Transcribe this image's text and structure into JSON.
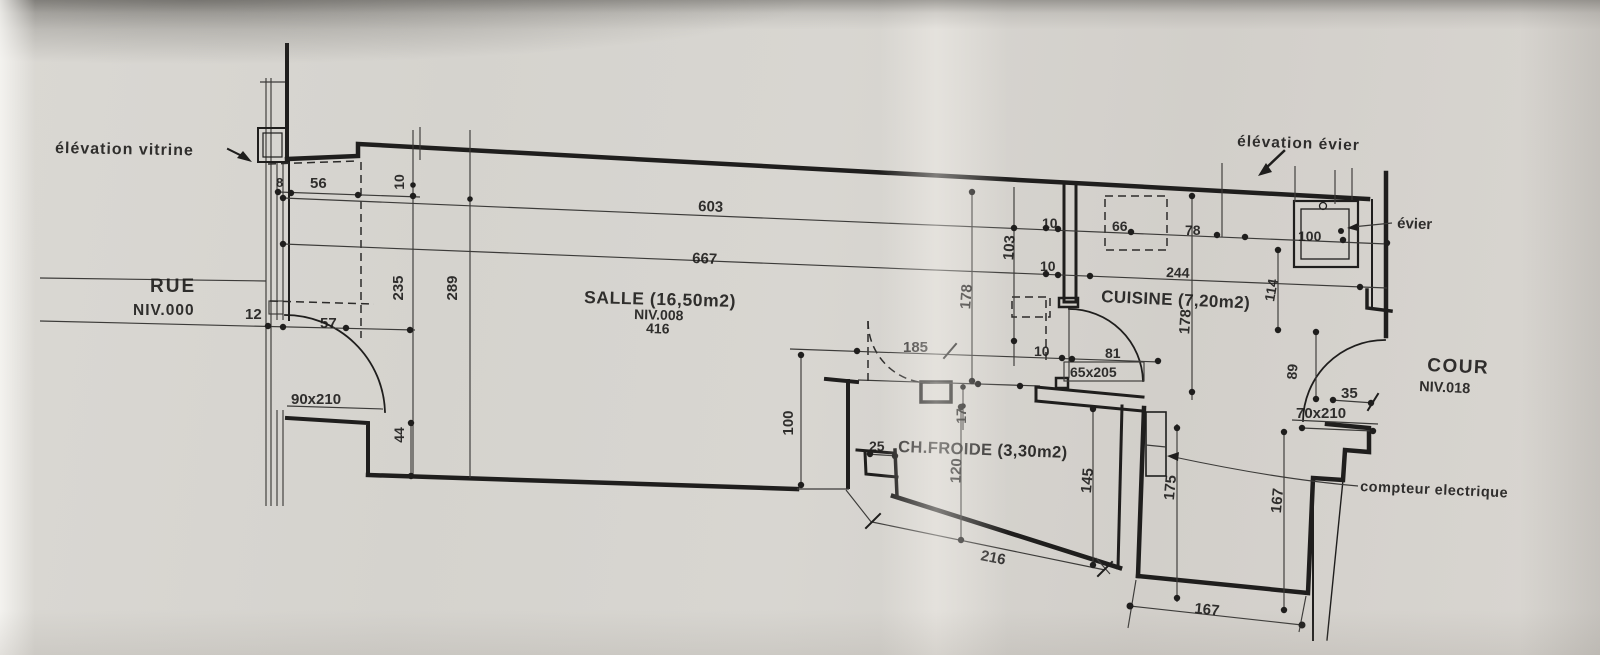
{
  "annotations": {
    "elevation_vitrine": "élévation vitrine",
    "elevation_evier": "élévation évier",
    "evier": "évier",
    "compteur": "compteur electrique"
  },
  "rooms": {
    "rue": {
      "name": "RUE",
      "level": "NIV.000"
    },
    "salle": {
      "name": "SALLE (16,50m2)",
      "level": "NIV.008",
      "extra": "416"
    },
    "cuisine": {
      "name": "CUISINE (7,20m2)"
    },
    "ch_froide": {
      "name": "CH.FROIDE (3,30m2)"
    },
    "cour": {
      "name": "COUR",
      "level": "NIV.018"
    }
  },
  "dims": {
    "d8": "8",
    "d56": "56",
    "d10_step": "10",
    "d603": "603",
    "d667": "667",
    "d12": "12",
    "d57": "57",
    "d90x210": "90x210",
    "d235": "235",
    "d289": "289",
    "d44": "44",
    "d100_left": "100",
    "d185": "185",
    "d10_door": "10",
    "d81": "81",
    "d65x205": "65x205",
    "d17": "17",
    "d120": "120",
    "d145": "145",
    "d216": "216",
    "d25": "25",
    "d10_upper": "10",
    "d10_lower": "10",
    "d66": "66",
    "d78": "78",
    "d244": "244",
    "d100_sink": "100",
    "d103": "103",
    "d178_salle": "178",
    "d178_cuisine": "178",
    "d114": "114",
    "d89": "89",
    "d35": "35",
    "d70x210": "70x210",
    "d175": "175",
    "d167_v": "167",
    "d167_h": "167"
  },
  "colors": {
    "paper": "#d6d4cf",
    "ink": "#1f1e1d"
  }
}
